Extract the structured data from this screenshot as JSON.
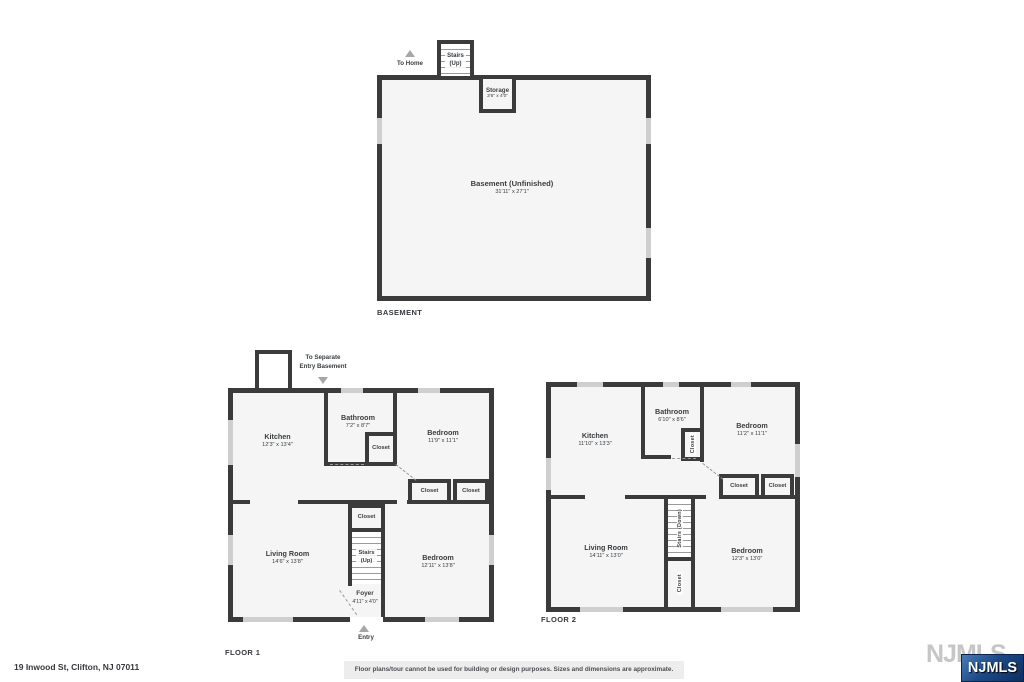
{
  "colors": {
    "wall": "#3b3b3b",
    "room_fill": "#f5f5f5",
    "window": "#cfcfcf",
    "logo_blue": "#123a6d",
    "watermark_gray": "#c6c6c6"
  },
  "basement": {
    "title": "BASEMENT",
    "to_home": "To Home",
    "stairs": "Stairs\n(Up)",
    "storage_name": "Storage",
    "storage_dims": "3'6\" x 4'0\"",
    "room_name": "Basement (Unfinished)",
    "room_dims": "31'11\" x 27'1\""
  },
  "floor1": {
    "title": "FLOOR 1",
    "annotation": "To Separate\nEntry Basement",
    "entry": "Entry",
    "stairs": "Stairs\n(Up)",
    "closet": "Closet",
    "kitchen": {
      "name": "Kitchen",
      "dims": "12'3\" x 13'4\""
    },
    "bathroom": {
      "name": "Bathroom",
      "dims": "7'2\" x 8'7\""
    },
    "bedroom1": {
      "name": "Bedroom",
      "dims": "11'9\" x 11'1\""
    },
    "living": {
      "name": "Living Room",
      "dims": "14'6\" x 13'8\""
    },
    "bedroom2": {
      "name": "Bedroom",
      "dims": "12'11\" x 13'8\""
    },
    "foyer": {
      "name": "Foyer",
      "dims": "4'11\" x 4'0\""
    }
  },
  "floor2": {
    "title": "FLOOR 2",
    "stairs": "Stairs (Down)",
    "closet": "Closet",
    "kitchen": {
      "name": "Kitchen",
      "dims": "11'10\" x 13'3\""
    },
    "bathroom": {
      "name": "Bathroom",
      "dims": "6'10\" x 8'6\""
    },
    "bedroom1": {
      "name": "Bedroom",
      "dims": "11'2\" x 11'1\""
    },
    "living": {
      "name": "Living Room",
      "dims": "14'11\" x 13'0\""
    },
    "bedroom2": {
      "name": "Bedroom",
      "dims": "12'3\" x 13'0\""
    }
  },
  "footer": {
    "address": "19 Inwood St, Clifton, NJ 07011",
    "disclaimer": "Floor plans/tour cannot be used for building or design purposes. Sizes and dimensions are approximate.",
    "logo": "NJMLS",
    "watermark": "NJMLS"
  }
}
